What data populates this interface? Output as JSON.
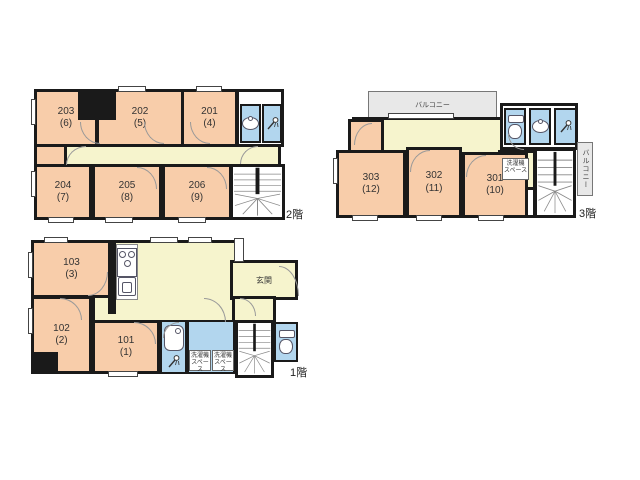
{
  "colors": {
    "wall": "#1a1a1a",
    "room": "#f8cdaa",
    "corridor": "#f6f4cd",
    "wet": "#b2d6ee",
    "balcony": "#e8e8e8",
    "text": "#333333"
  },
  "floors": {
    "f1": {
      "label": "1階",
      "entrance": "玄関",
      "rooms": [
        {
          "number": "103",
          "alias": "(3)"
        },
        {
          "number": "102",
          "alias": "(2)"
        },
        {
          "number": "101",
          "alias": "(1)"
        }
      ],
      "laundry_a": {
        "line1": "洗濯機",
        "line2": "スペース"
      },
      "laundry_b": {
        "line1": "洗濯機",
        "line2": "スペース"
      }
    },
    "f2": {
      "label": "2階",
      "rooms": [
        {
          "number": "203",
          "alias": "(6)"
        },
        {
          "number": "202",
          "alias": "(5)"
        },
        {
          "number": "201",
          "alias": "(4)"
        },
        {
          "number": "204",
          "alias": "(7)"
        },
        {
          "number": "205",
          "alias": "(8)"
        },
        {
          "number": "206",
          "alias": "(9)"
        }
      ]
    },
    "f3": {
      "label": "3階",
      "balcony_top": "バルコニー",
      "balcony_side": "バルコニー",
      "laundry": {
        "line1": "洗濯機",
        "line2": "スペース"
      },
      "rooms": [
        {
          "number": "303",
          "alias": "(12)"
        },
        {
          "number": "302",
          "alias": "(11)"
        },
        {
          "number": "301",
          "alias": "(10)"
        }
      ]
    }
  }
}
